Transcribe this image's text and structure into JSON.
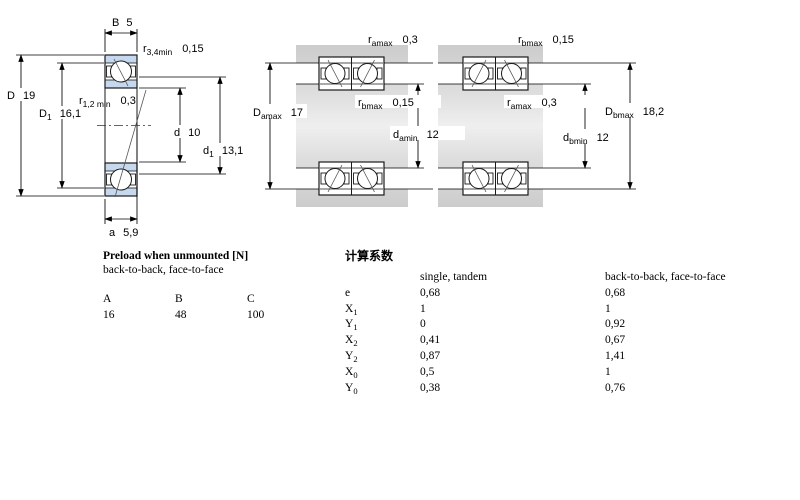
{
  "diagram": {
    "single_bearing": {
      "B": {
        "sym": "B",
        "value": "5"
      },
      "r34": {
        "sym": "r",
        "sub": "3,4min",
        "value": "0,15"
      },
      "r12": {
        "sym": "r",
        "sub": "1,2 min",
        "value": "0,3"
      },
      "D": {
        "sym": "D",
        "value": "19"
      },
      "D1": {
        "sym": "D",
        "sub": "1",
        "value": "16,1"
      },
      "d": {
        "sym": "d",
        "value": "10"
      },
      "d1": {
        "sym": "d",
        "sub": "1",
        "value": "13,1"
      },
      "a": {
        "sym": "a",
        "value": "5,9"
      }
    },
    "pair_back_to_back": {
      "ramax": {
        "sym": "r",
        "sub": "amax",
        "value": "0,3"
      },
      "rbmax": {
        "sym": "r",
        "sub": "bmax",
        "value": "0,15"
      },
      "Damax": {
        "sym": "D",
        "sub": "amax",
        "value": "17"
      },
      "damin": {
        "sym": "d",
        "sub": "amin",
        "value": "12"
      }
    },
    "pair_face_to_face": {
      "rbmax": {
        "sym": "r",
        "sub": "bmax",
        "value": "0,15"
      },
      "ramax": {
        "sym": "r",
        "sub": "amax",
        "value": "0,3"
      },
      "Dbmax": {
        "sym": "D",
        "sub": "bmax",
        "value": "18,2"
      },
      "dbmin": {
        "sym": "d",
        "sub": "bmin",
        "value": "12"
      }
    }
  },
  "preload_table": {
    "title": "Preload when unmounted [N]",
    "subtitle": "back-to-back, face-to-face",
    "columns": [
      "A",
      "B",
      "C"
    ],
    "values": [
      "16",
      "48",
      "100"
    ]
  },
  "factors_table": {
    "title": "计算系数",
    "col1_header": "single, tandem",
    "col2_header": "back-to-back, face-to-face",
    "rows": [
      {
        "sym": "e",
        "sub": "",
        "v1": "0,68",
        "v2": "0,68"
      },
      {
        "sym": "X",
        "sub": "1",
        "v1": "1",
        "v2": "1"
      },
      {
        "sym": "Y",
        "sub": "1",
        "v1": "0",
        "v2": "0,92"
      },
      {
        "sym": "X",
        "sub": "2",
        "v1": "0,41",
        "v2": "0,67"
      },
      {
        "sym": "Y",
        "sub": "2",
        "v1": "0,87",
        "v2": "1,41"
      },
      {
        "sym": "X",
        "sub": "0",
        "v1": "0,5",
        "v2": "1"
      },
      {
        "sym": "Y",
        "sub": "0",
        "v1": "0,38",
        "v2": "0,76"
      }
    ]
  },
  "colors": {
    "ring_fill": "#c6d8ee",
    "steel_gray": "#d9d9d9",
    "line": "#000000"
  }
}
